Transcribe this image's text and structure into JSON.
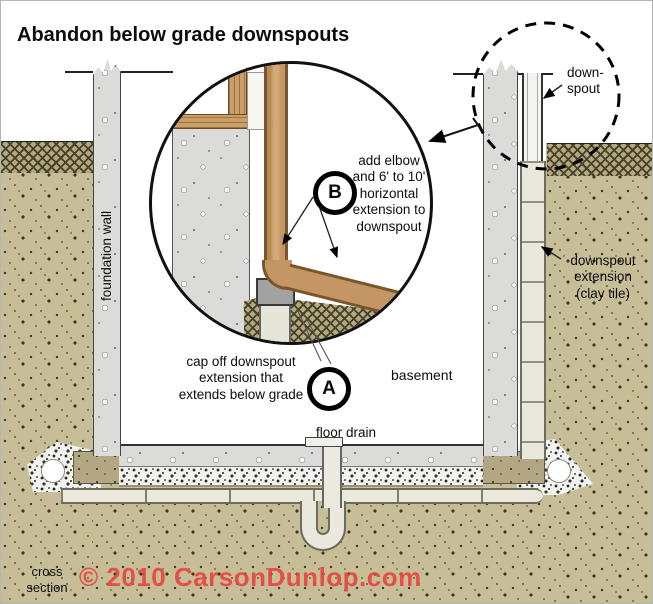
{
  "title": "Abandon below grade downspouts",
  "callouts": {
    "b": {
      "letter": "B",
      "text": "add elbow\nand 6' to 10'\nhorizontal\nextension to\ndownspout"
    },
    "a": {
      "letter": "A",
      "text": "cap off downspout\nextension that\nextends below grade"
    }
  },
  "labels": {
    "downspout": "down-\nspout",
    "foundation_wall": "foundation wall",
    "downspout_extension": "downspout\nextension\n(clay tile)",
    "basement": "basement",
    "floor_drain": "floor drain",
    "cross_section": "cross\nsection"
  },
  "footer": {
    "copyright": "© 2010 CarsonDunlop.com"
  },
  "colors": {
    "soil": "#c7be98",
    "topsoil_hatch": "#45402c",
    "concrete": "#dbdbd9",
    "wood_downspout": "#c49663",
    "clay_pipe": "#ebe9dd",
    "cap_gray": "#a2a2a2",
    "copyright_red": "#e8453f",
    "ink": "#111111"
  }
}
